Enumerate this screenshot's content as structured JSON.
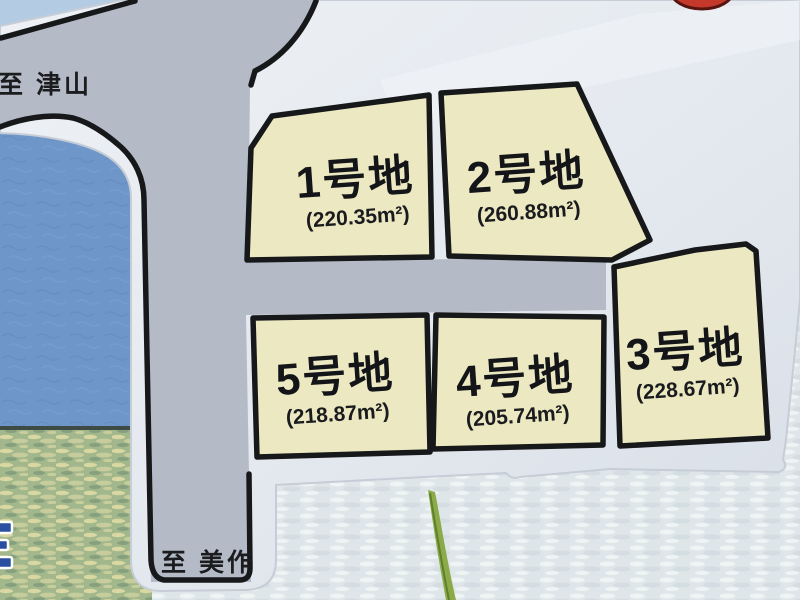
{
  "map": {
    "road_labels": {
      "to_tsuyama": "至 津山",
      "to_mimasaka": "至 美作"
    },
    "lots": [
      {
        "name": "1号地",
        "area_m2": "220.35",
        "area_label": "(220.35m²)"
      },
      {
        "name": "2号地",
        "area_m2": "260.88",
        "area_label": "(260.88m²)"
      },
      {
        "name": "3号地",
        "area_m2": "228.67",
        "area_label": "(228.67m²)"
      },
      {
        "name": "4号地",
        "area_m2": "205.74",
        "area_label": "(205.74m²)"
      },
      {
        "name": "5号地",
        "area_m2": "218.87",
        "area_label": "(218.87m²)"
      }
    ],
    "colors": {
      "lot_fill": "#ece9c2",
      "road_fill": "#b4bbc7",
      "outline": "#17181a",
      "panel_white": "#e7ebf1",
      "wall_blue": "#6f96c9",
      "sky_corner": "#b3cbe3",
      "field_green": "#a2b78c",
      "sea_pale": "#dfe6ea",
      "red_marker": "#c5392c",
      "grass_green": "#8cab48"
    }
  }
}
